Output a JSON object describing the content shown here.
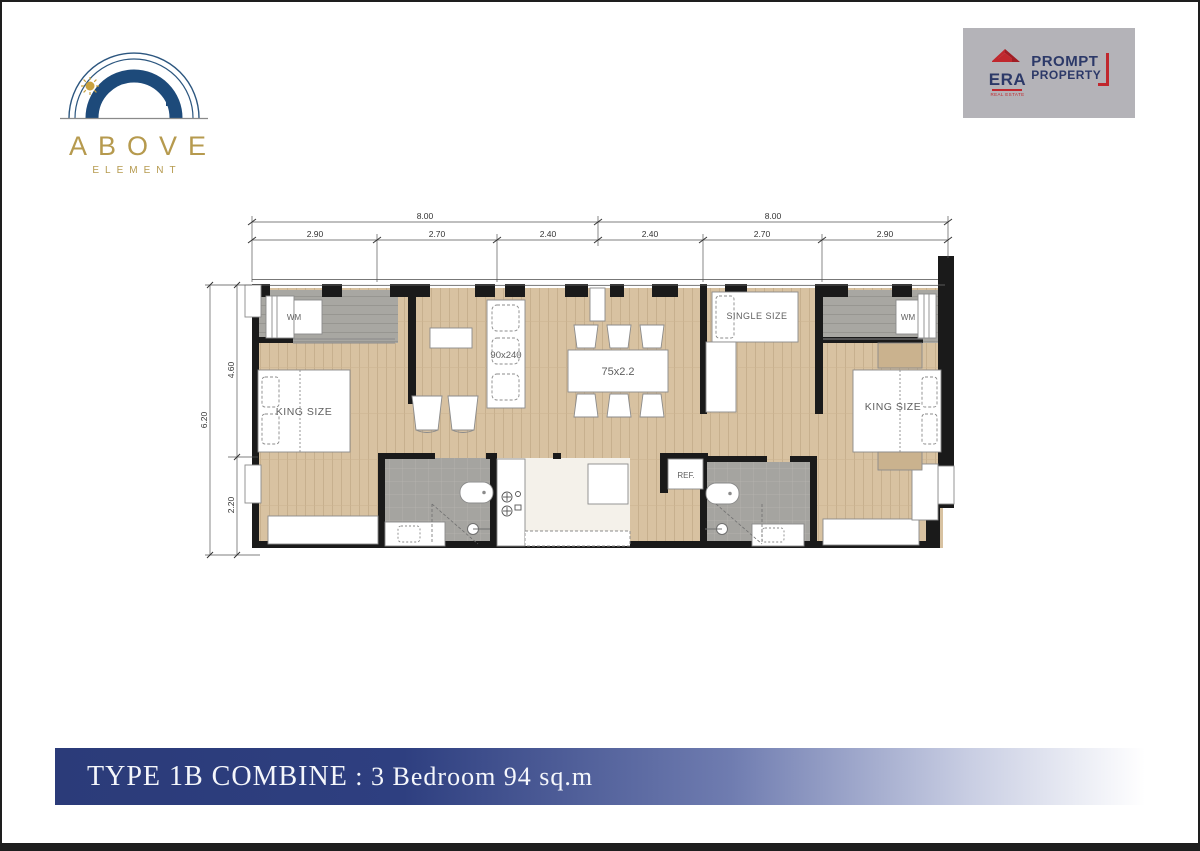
{
  "logo": {
    "title": "ABOVE",
    "subtitle": "ELEMENT"
  },
  "agency": {
    "name": "ERA",
    "tagline": "REAL ESTATE",
    "line1": "PROMPT",
    "line2": "PROPERTY"
  },
  "banner": {
    "title": "TYPE 1B COMBINE",
    "separator": " : ",
    "subtitle": "3 Bedroom 94 sq.m"
  },
  "plan": {
    "dims": {
      "top_overall": [
        "8.00",
        "8.00"
      ],
      "top_segments": [
        "2.90",
        "2.70",
        "2.40",
        "2.40",
        "2.70",
        "2.90"
      ],
      "left_overall": "6.20",
      "left_segments": [
        "4.60",
        "2.20"
      ]
    },
    "labels": {
      "wm_left": "WM",
      "wm_right": "WM",
      "king_left": "KING SIZE",
      "king_right": "KING SIZE",
      "single": "SINGLE SIZE",
      "sofa": "90x240",
      "dining": "75x2.2",
      "fridge": "REF."
    }
  },
  "colors": {
    "wood": "#d8c2a1",
    "tile_gray": "#a8a7a2",
    "wall": "#1a1a1a",
    "banner_navy": "#2b3b79",
    "logo_gold": "#b69a4e",
    "logo_navy": "#1d4a7a",
    "agency_red": "#c0272d",
    "agency_navy": "#2c3968",
    "agency_gray": "#b4b3b8"
  }
}
